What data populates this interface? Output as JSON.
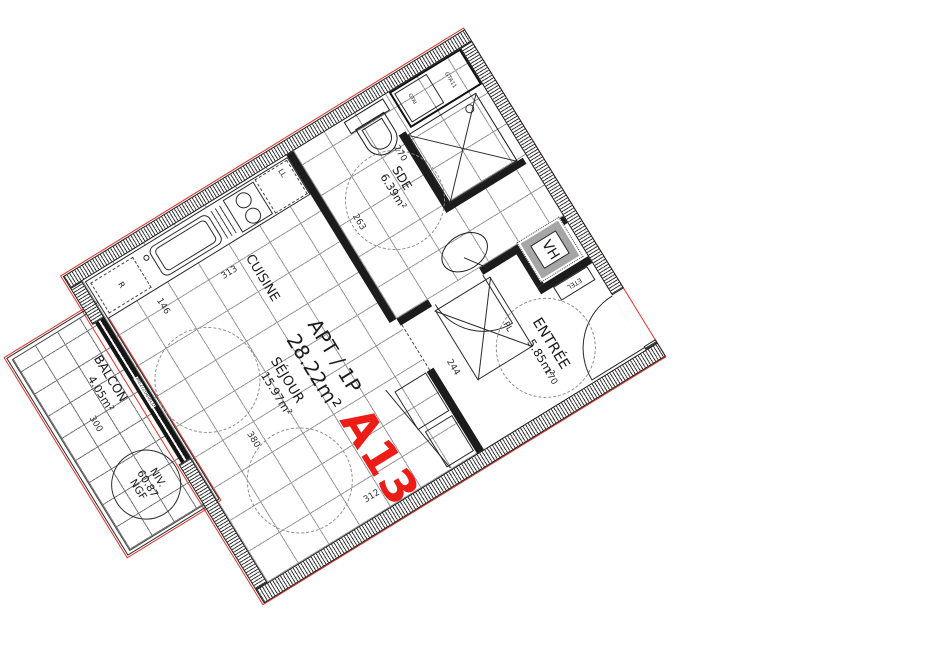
{
  "drawing": {
    "title": {
      "type_label": "APT / 1P",
      "total_area": "28.22m²",
      "unit_number": "A13"
    },
    "rooms": {
      "sejour": {
        "name": "SÉJOUR",
        "area": "15.97m²"
      },
      "cuisine": {
        "name": "CUISINE"
      },
      "sde": {
        "name": "SDE",
        "area": "6.39m²"
      },
      "entree": {
        "name": "ENTRÉE",
        "area": "5.85m²"
      },
      "balcon": {
        "name": "BALCON",
        "area": "4.05m²"
      }
    },
    "level_marker": {
      "line1": "NIV.",
      "line2": "60.87",
      "line3": "NGF"
    },
    "equipment": {
      "vh": "VH",
      "etel": "ETEL",
      "placard": "PL",
      "washer": "LL",
      "fridge": "R",
      "duct_small": "GTAI",
      "duct_main": "GTA11",
      "window_ref": "ME2/2080/LD"
    },
    "dimensions": {
      "kitchen_run": "313",
      "kitchen_return": "146",
      "sde_depth": "263",
      "sde_width": "270",
      "entree_depth": "244",
      "entree_width": "170",
      "sejour_width": "312",
      "sejour_length": "380",
      "balcon_length": "300"
    },
    "colors": {
      "unit_red": "#ed1c16",
      "boundary_red": "#e03127",
      "wall": "#1c1c1c"
    }
  }
}
